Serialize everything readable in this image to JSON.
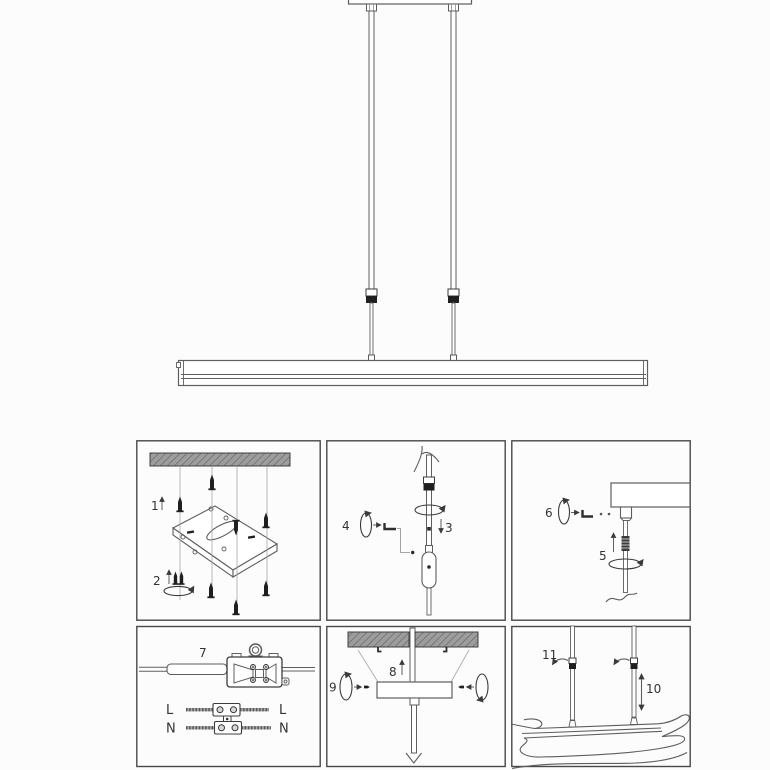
{
  "colors": {
    "background": "#fcfcfc",
    "line": "#5e5e5e",
    "dark_fill": "#1f1f1f",
    "panel_border": "#484848",
    "ceiling_fill": "#9d9d9d",
    "ceiling_hatch": "#6f6f6f",
    "label_color": "#333333"
  },
  "labels": {
    "step1": "1",
    "step2": "2",
    "step3": "3",
    "step4": "4",
    "step5": "5",
    "step6": "6",
    "step7": "7",
    "step8": "8",
    "step9": "9",
    "step10": "10",
    "step11": "11",
    "live_left": "L",
    "live_right": "L",
    "neutral_left": "N",
    "neutral_right": "N"
  },
  "panels": [
    {
      "name": "ceiling-bracket-mounting",
      "steps": [
        "1",
        "2"
      ]
    },
    {
      "name": "suspension-cable-adjustment",
      "steps": [
        "3",
        "4"
      ]
    },
    {
      "name": "rod-to-canopy-fixing",
      "steps": [
        "5",
        "6"
      ]
    },
    {
      "name": "mains-wiring-connection",
      "steps": [
        "7"
      ]
    },
    {
      "name": "canopy-to-ceiling-mounting",
      "steps": [
        "8",
        "9"
      ]
    },
    {
      "name": "height-adjustment",
      "steps": [
        "10",
        "11"
      ]
    }
  ]
}
